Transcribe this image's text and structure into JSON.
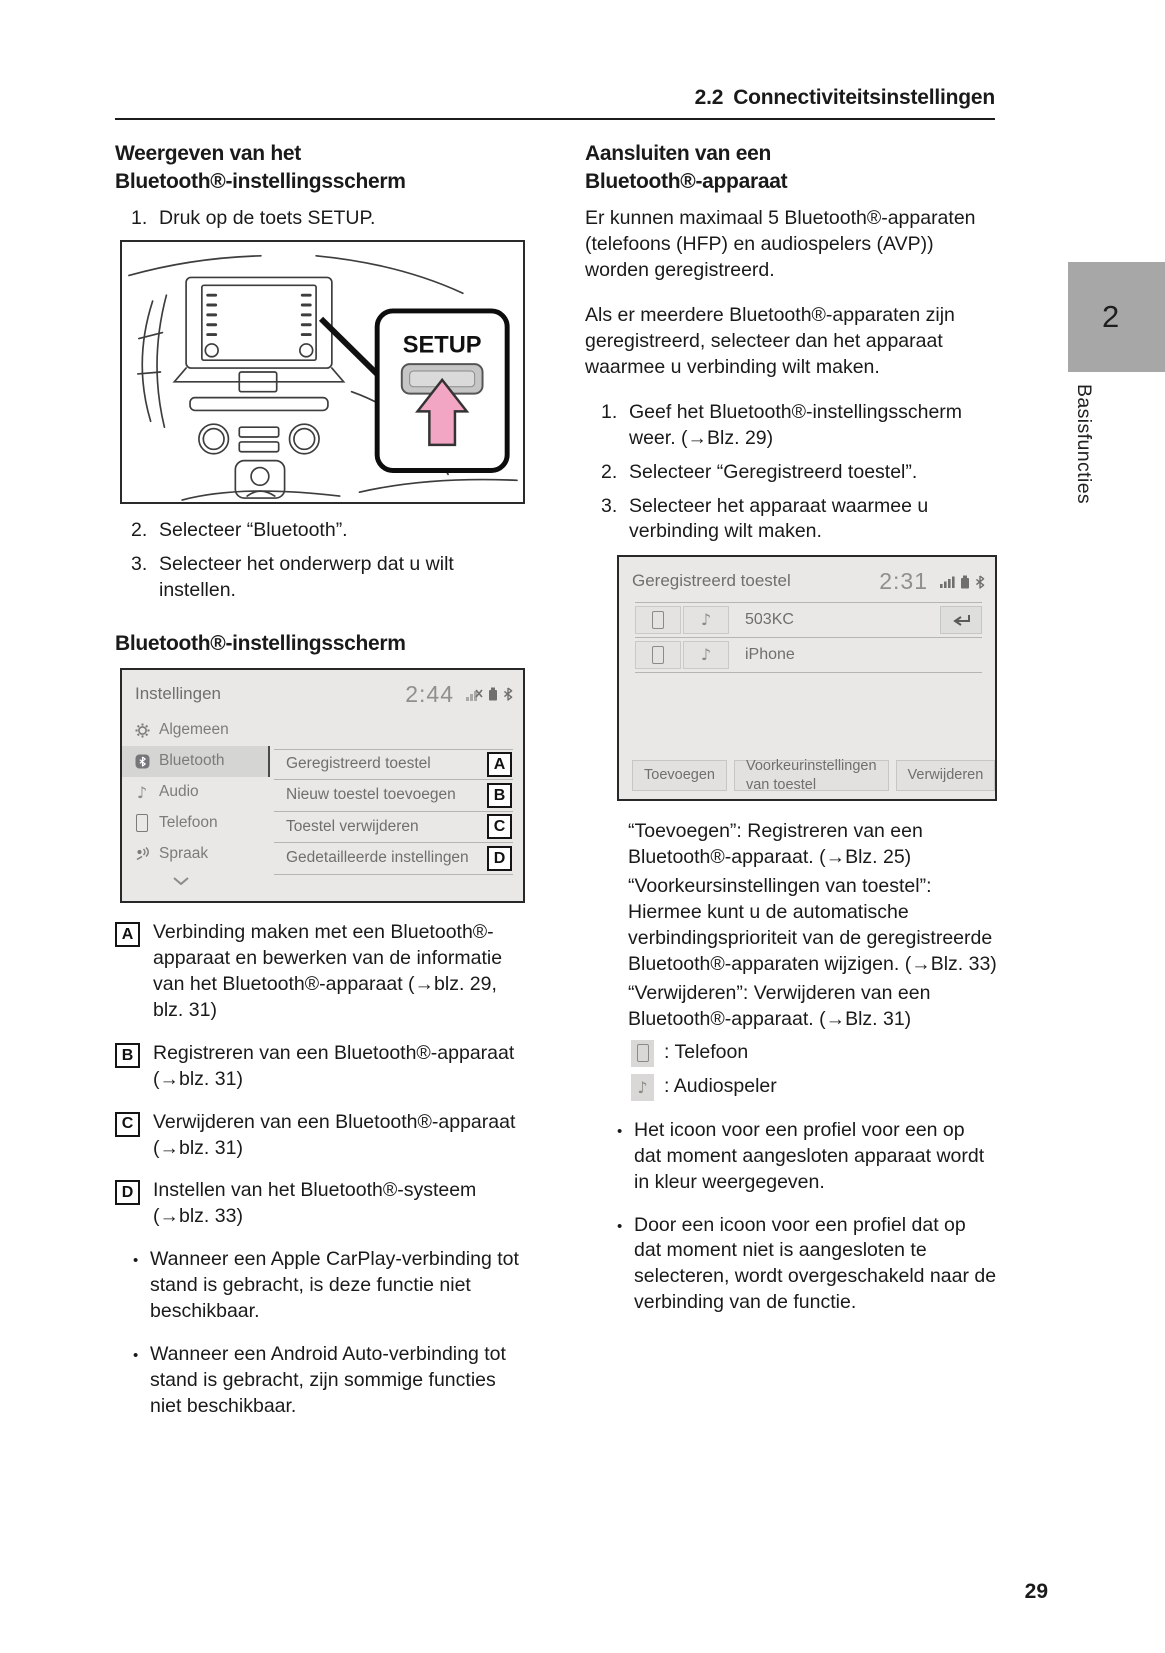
{
  "header": {
    "number": "2.2",
    "title": "Connectiviteitsinstellingen"
  },
  "chapter_tab": {
    "number": "2",
    "label": "Basisfuncties"
  },
  "page_number": "29",
  "left": {
    "heading1_lines": [
      "Weergeven van het",
      "Bluetooth®-instellingsscherm"
    ],
    "step1": {
      "num": "1.",
      "text": "Druk op de toets SETUP."
    },
    "dashboard": {
      "button_label": "SETUP"
    },
    "step2": {
      "num": "2.",
      "text": "Selecteer “Bluetooth”."
    },
    "step3": {
      "num": "3.",
      "text": "Selecteer het onderwerp dat u wilt instellen."
    },
    "heading2": "Bluetooth®-instellingsscherm",
    "settings_screen": {
      "title": "Instellingen",
      "time": "2:44",
      "menu": [
        {
          "label": "Algemeen"
        },
        {
          "label": "Bluetooth"
        },
        {
          "label": "Audio"
        },
        {
          "label": "Telefoon"
        },
        {
          "label": "Spraak"
        }
      ],
      "items": [
        {
          "label": "Geregistreerd toestel",
          "tag": "A"
        },
        {
          "label": "Nieuw toestel toevoegen",
          "tag": "B"
        },
        {
          "label": "Toestel verwijderen",
          "tag": "C"
        },
        {
          "label": "Gedetailleerde instellingen",
          "tag": "D"
        }
      ]
    },
    "legend": [
      {
        "tag": "A",
        "text": "Verbinding maken met een Bluetooth®-apparaat en bewerken van de informatie van het Bluetooth®-apparaat (→blz. 29, blz. 31)"
      },
      {
        "tag": "B",
        "text": "Registreren van een Bluetooth®-apparaat (→blz. 31)"
      },
      {
        "tag": "C",
        "text": "Verwijderen van een Bluetooth®-apparaat (→blz. 31)"
      },
      {
        "tag": "D",
        "text": "Instellen van het Bluetooth®-systeem (→blz. 33)"
      }
    ],
    "bullets": [
      "Wanneer een Apple CarPlay-verbinding tot stand is gebracht, is deze functie niet beschikbaar.",
      "Wanneer een Android Auto-verbinding tot stand is gebracht, zijn sommige functies niet beschikbaar."
    ]
  },
  "right": {
    "heading1_lines": [
      "Aansluiten van een",
      "Bluetooth®-apparaat"
    ],
    "para1": "Er kunnen maximaal 5 Bluetooth®-apparaten (telefoons (HFP) en audiospelers (AVP)) worden geregistreerd.",
    "para2": "Als er meerdere Bluetooth®-apparaten zijn geregistreerd, selecteer dan het apparaat waarmee u verbinding wilt maken.",
    "steps": [
      {
        "num": "1.",
        "text": "Geef het Bluetooth®-instellingsscherm weer. (→Blz. 29)"
      },
      {
        "num": "2.",
        "text": "Selecteer “Geregistreerd toestel”."
      },
      {
        "num": "3.",
        "text": "Selecteer het apparaat waarmee u verbinding wilt maken."
      }
    ],
    "device_screen": {
      "title": "Geregistreerd toestel",
      "time": "2:31",
      "devices": [
        {
          "name": "503KC"
        },
        {
          "name": "iPhone"
        }
      ],
      "buttons": [
        "Toevoegen",
        "Voorkeurinstellingen van toestel",
        "Verwijderen"
      ]
    },
    "explanations": [
      "“Toevoegen”: Registreren van een Bluetooth®-apparaat. (→Blz. 25)",
      "“Voorkeursinstellingen van toestel”: Hiermee kunt u de automatische verbindingsprioriteit van de geregistreerde Bluetooth®-apparaten wijzigen. (→Blz. 33)",
      "“Verwijderen”: Verwijderen van een Bluetooth®-apparaat. (→Blz. 31)"
    ],
    "icon_legend": [
      {
        "label": ": Telefoon"
      },
      {
        "label": ": Audiospeler"
      }
    ],
    "bullets": [
      "Het icoon voor een profiel voor een op dat moment aangesloten apparaat wordt in kleur weergegeven.",
      "Door een icoon voor een profiel dat op dat moment niet is aangesloten te selecteren, wordt overgeschakeld naar de verbinding van de functie."
    ]
  }
}
